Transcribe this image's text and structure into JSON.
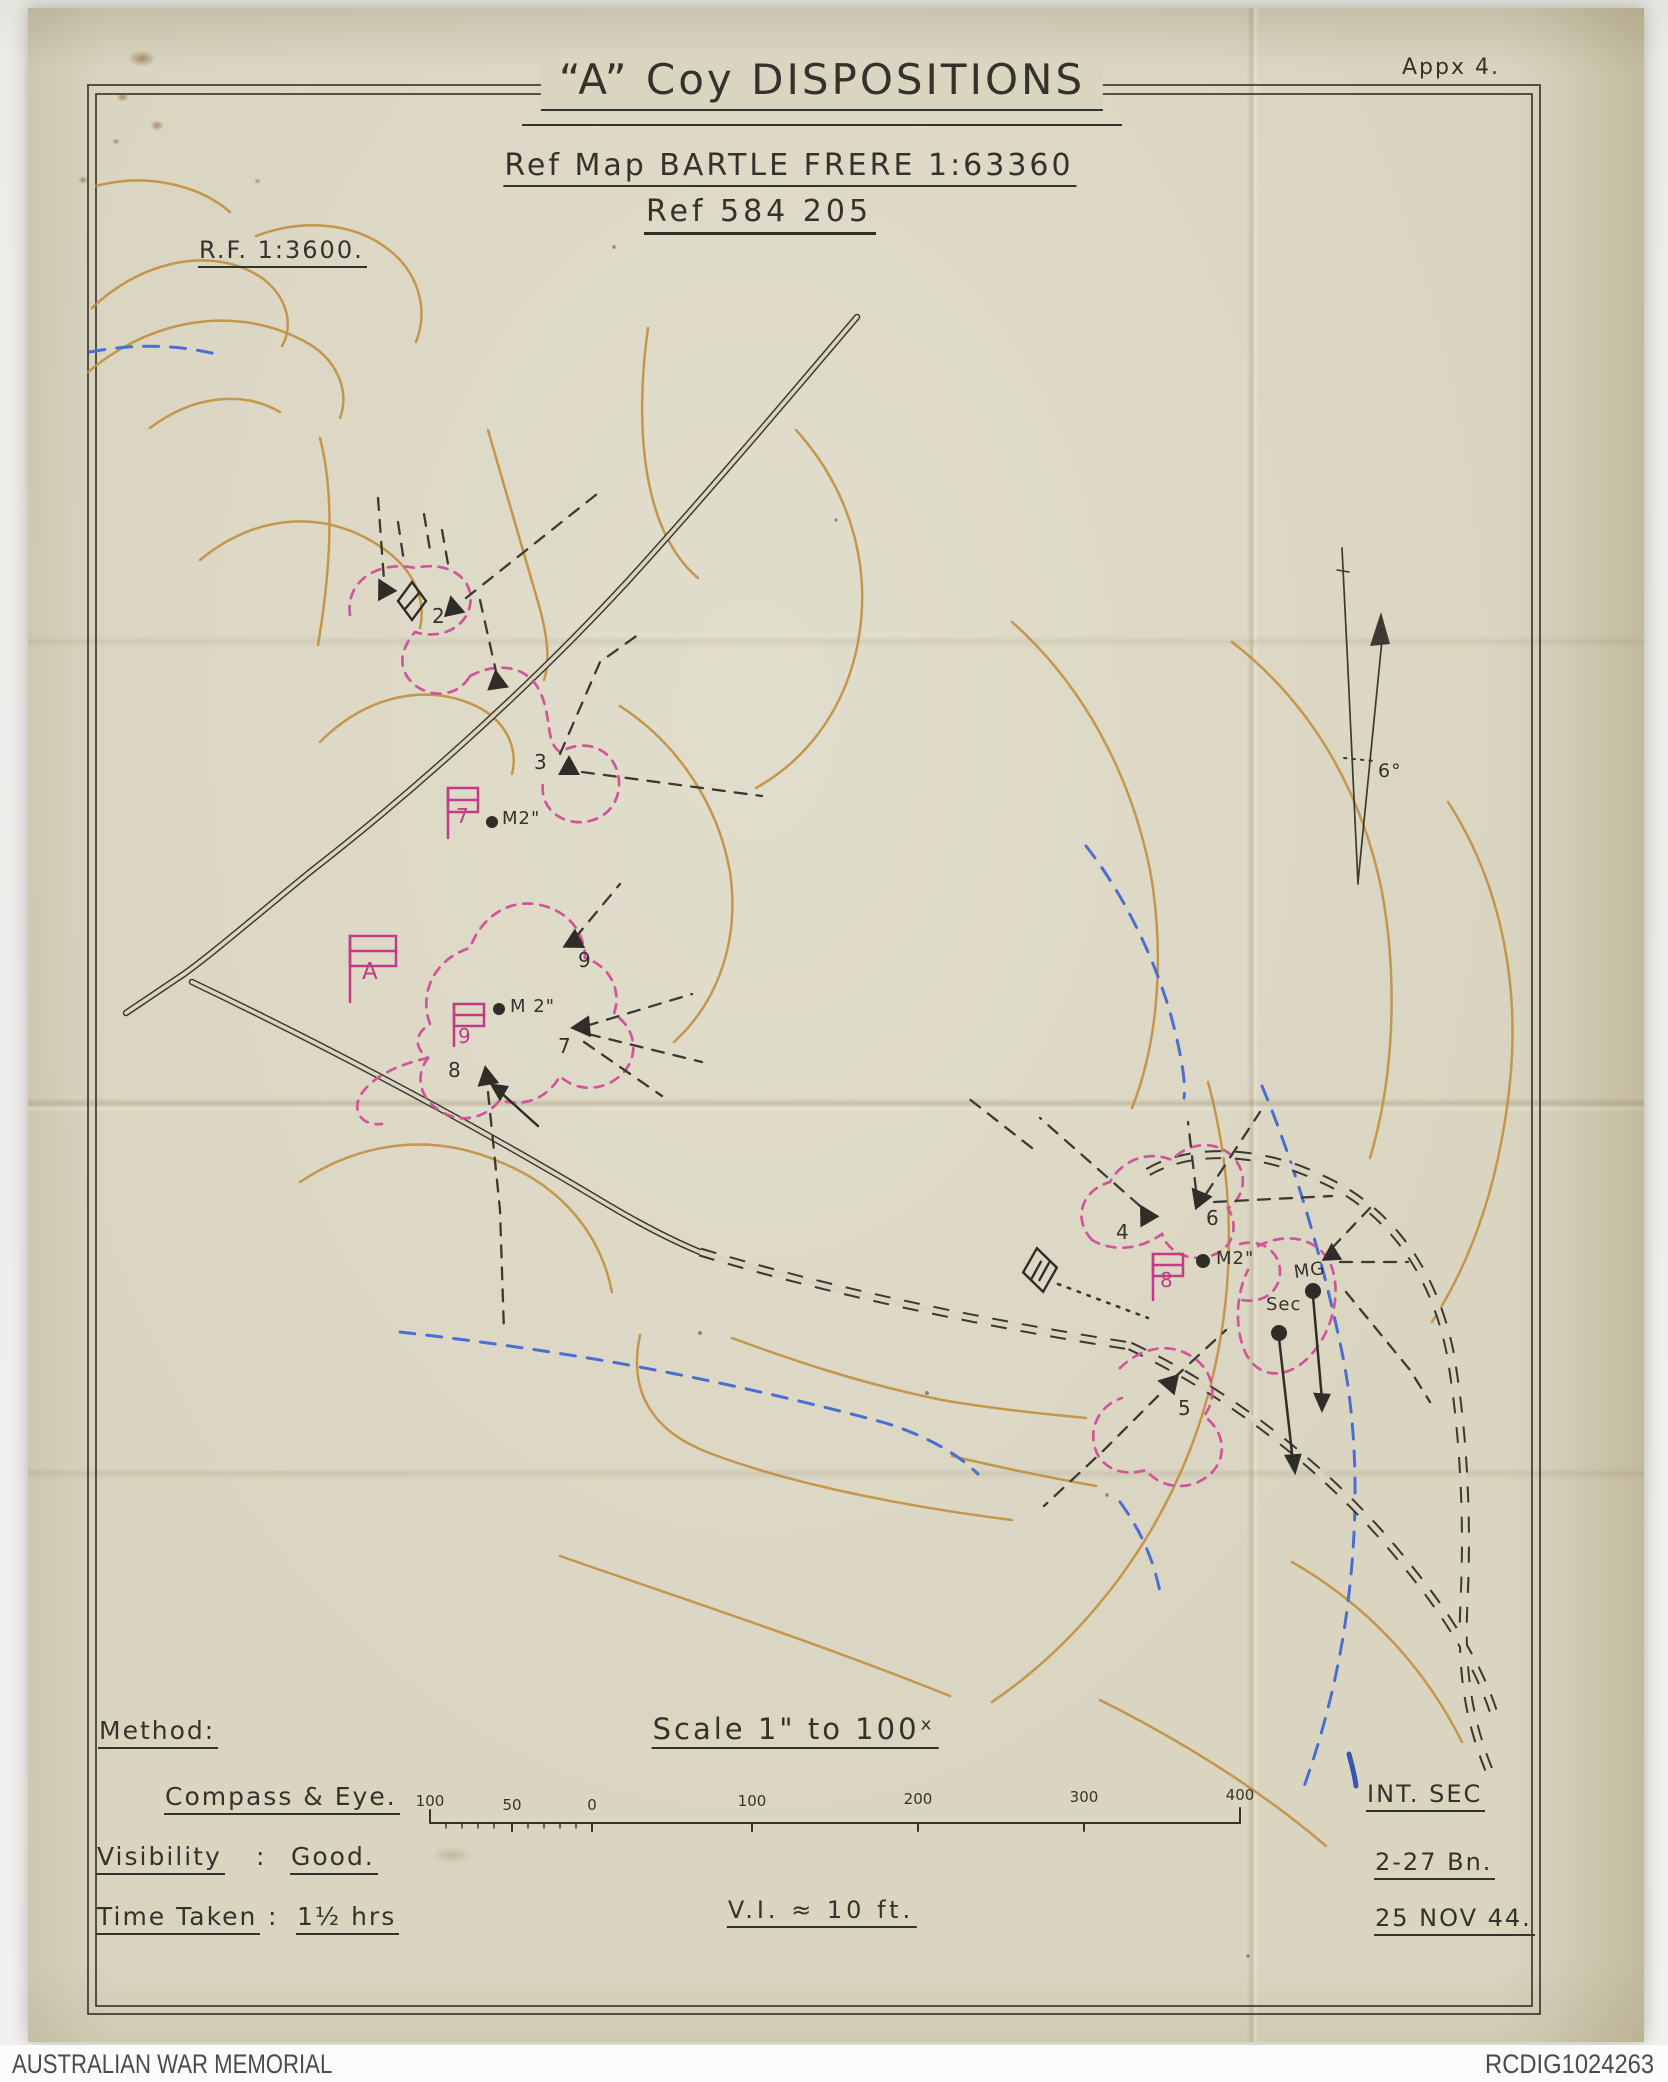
{
  "header": {
    "appendix": "Appx 4.",
    "title": "“A” Coy DISPOSITIONS",
    "ref_map": "Ref Map BARTLE FRERE 1:63360",
    "ref_point": "Ref 584 205",
    "rf": "R.F. 1:3600."
  },
  "map": {
    "declination": "6°",
    "posts": {
      "p2": "2",
      "p3": "3",
      "p9": "9",
      "p7": "7",
      "p8": "8",
      "p4": "4",
      "p6": "6",
      "p5": "5"
    },
    "flags": {
      "f7": "7",
      "fA": "A",
      "f9": "9",
      "f8": "8"
    },
    "weapons": {
      "mortar1": "M2\"",
      "mortar2": "M 2\"",
      "mortar3": "M2\"",
      "mg": "MG",
      "sec": "Sec"
    }
  },
  "scale": {
    "title": "Scale 1\" to 100ˣ",
    "bar_labels": [
      "100",
      "50",
      "0",
      "100",
      "200",
      "300",
      "400"
    ],
    "vi": "V.I. ≈ 10 ft."
  },
  "legend": {
    "method_label": "Method:",
    "method_value": "Compass & Eye.",
    "visibility_label": "Visibility",
    "colon": ":",
    "visibility_value": "Good.",
    "time_label": "Time Taken",
    "time_value": "1½ hrs"
  },
  "attribution": {
    "unit_section": "INT. SEC",
    "unit": "2-27 Bn.",
    "date": "25 NOV 44."
  },
  "credit": {
    "left": "AUSTRALIAN WAR MEMORIAL",
    "right": "RCDIG1024263"
  },
  "colors": {
    "paper": "#dad5c1",
    "ink": "#34332b",
    "contour": "#c28f3e",
    "pink_dash": "#d0559a",
    "flag_magenta": "#c23b86",
    "water_blue": "#4a6fd0",
    "credit_text": "#4b4b49"
  }
}
